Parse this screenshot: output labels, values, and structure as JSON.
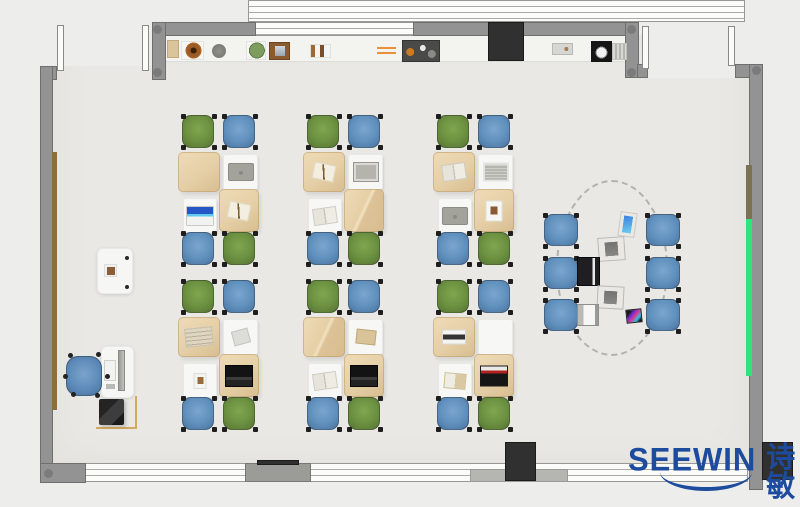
{
  "scene": {
    "kind": "floorplan-top-view-render",
    "room": "classroom / training room furniture layout render",
    "canvas": {
      "w": 800,
      "h": 507
    },
    "colors": {
      "outside": "#ededeb",
      "floor": "#e9e8e4",
      "wall": "#939393",
      "desk_tan": "#e5cfa6",
      "desk_white": "#f7f7f5",
      "chair_green": "#6b9040",
      "chair_blue": "#6090bd",
      "accent_strip_green": "#2ee57c",
      "logo_blue": "#1d4b9e"
    }
  },
  "logo": {
    "brand": "SEEWIN",
    "cjk": "诗敏"
  },
  "layout": {
    "statics": [
      {
        "cls": "floor",
        "name": "room-floor",
        "x": 53,
        "y": 35,
        "w": 696,
        "h": 428
      },
      {
        "cls": "outside",
        "name": "outside-area-top-left",
        "x": 0,
        "y": 0,
        "w": 152,
        "h": 66
      },
      {
        "cls": "outside",
        "name": "outside-area-top-right",
        "x": 648,
        "y": 0,
        "w": 101,
        "h": 78
      },
      {
        "cls": "counter",
        "name": "back-counter",
        "x": 166,
        "y": 35,
        "w": 461,
        "h": 27
      },
      {
        "cls": "window-h",
        "name": "window-band-top",
        "x": 248,
        "y": 0,
        "w": 497,
        "h": 22
      },
      {
        "cls": "window-h",
        "name": "window-band-top-inner",
        "x": 248,
        "y": 22,
        "w": 166,
        "h": 14
      },
      {
        "cls": "wall",
        "name": "wall-top-left-segment",
        "x": 152,
        "y": 22,
        "w": 104,
        "h": 14
      },
      {
        "cls": "wall",
        "name": "wall-top-right-segment",
        "x": 413,
        "y": 22,
        "w": 214,
        "h": 14
      },
      {
        "cls": "wall",
        "name": "door-post-left",
        "x": 152,
        "y": 22,
        "w": 14,
        "h": 58
      },
      {
        "cls": "wall",
        "name": "wall-corner-top-left",
        "x": 40,
        "y": 66,
        "w": 17,
        "h": 14
      },
      {
        "cls": "wall",
        "name": "wall-left",
        "x": 40,
        "y": 66,
        "w": 13,
        "h": 416
      },
      {
        "cls": "wall",
        "name": "door-post-right",
        "x": 625,
        "y": 22,
        "w": 14,
        "h": 56
      },
      {
        "cls": "wall",
        "name": "door-post-right-foot",
        "x": 637,
        "y": 64,
        "w": 11,
        "h": 14
      },
      {
        "cls": "wall",
        "name": "wall-corner-top-right",
        "x": 735,
        "y": 64,
        "w": 28,
        "h": 14
      },
      {
        "cls": "wall",
        "name": "wall-right",
        "x": 749,
        "y": 64,
        "w": 14,
        "h": 426
      },
      {
        "cls": "door",
        "name": "door-leaf",
        "x": 57,
        "y": 25,
        "w": 7,
        "h": 46
      },
      {
        "cls": "door",
        "name": "door-leaf",
        "x": 142,
        "y": 25,
        "w": 7,
        "h": 46
      },
      {
        "cls": "door",
        "name": "door-leaf",
        "x": 642,
        "y": 26,
        "w": 7,
        "h": 43
      },
      {
        "cls": "door",
        "name": "door-leaf",
        "x": 728,
        "y": 26,
        "w": 7,
        "h": 40
      },
      {
        "cls": "window-h",
        "name": "window-band-bottom",
        "x": 57,
        "y": 463,
        "w": 691,
        "h": 19
      },
      {
        "cls": "sill",
        "name": "window-sill-gray",
        "x": 470,
        "y": 469,
        "w": 98,
        "h": 13
      },
      {
        "cls": "wall",
        "name": "wall-corner-bottom-left",
        "x": 40,
        "y": 463,
        "w": 46,
        "h": 20
      },
      {
        "cls": "pillar-gray",
        "name": "pillar-bottom-gray",
        "x": 245,
        "y": 463,
        "w": 66,
        "h": 19
      },
      {
        "cls": "dark",
        "name": "lintel-dark",
        "x": 257,
        "y": 460,
        "w": 42,
        "h": 5
      },
      {
        "cls": "dark",
        "name": "pillar-dark-center",
        "x": 505,
        "y": 442,
        "w": 31,
        "h": 39
      },
      {
        "cls": "dark",
        "name": "pillar-dark-right",
        "x": 762,
        "y": 442,
        "w": 31,
        "h": 38
      },
      {
        "cls": "dark",
        "name": "cabinet-black",
        "x": 488,
        "y": 22,
        "w": 36,
        "h": 39
      },
      {
        "cls": "strip-brown",
        "name": "wall-rail-left",
        "x": 52,
        "y": 152,
        "w": 5,
        "h": 258
      },
      {
        "cls": "strip-olive",
        "name": "wall-rail-right-olive",
        "x": 746,
        "y": 165,
        "w": 6,
        "h": 54
      },
      {
        "cls": "strip-green",
        "name": "wall-strip-green",
        "x": 746,
        "y": 219,
        "w": 6,
        "h": 157
      },
      {
        "cls": "wall-dot",
        "name": "wall-joint-dot",
        "x": 153,
        "y": 25,
        "w": 9,
        "h": 9
      },
      {
        "cls": "wall-dot",
        "name": "wall-joint-dot",
        "x": 153,
        "y": 68,
        "w": 9,
        "h": 9
      },
      {
        "cls": "wall-dot",
        "name": "wall-joint-dot",
        "x": 627,
        "y": 25,
        "w": 9,
        "h": 9
      },
      {
        "cls": "wall-dot",
        "name": "wall-joint-dot",
        "x": 627,
        "y": 68,
        "w": 9,
        "h": 9
      },
      {
        "cls": "wall-dot",
        "name": "wall-joint-dot",
        "x": 752,
        "y": 66,
        "w": 9,
        "h": 9
      },
      {
        "cls": "wall-dot",
        "name": "wall-joint-dot",
        "x": 44,
        "y": 469,
        "w": 9,
        "h": 9
      },
      {
        "cls": "pod-ring",
        "name": "pod-dashed-outline",
        "x": 556,
        "y": 180,
        "w": 112,
        "h": 176
      }
    ],
    "counter_items": [
      {
        "cls": "ci-tanbox",
        "name": "shelf-item-box",
        "x": 167,
        "y": 40,
        "w": 12,
        "h": 18
      },
      {
        "cls": "ci-bowl",
        "name": "shelf-item-bowl",
        "x": 181,
        "y": 41,
        "w": 23,
        "h": 19
      },
      {
        "cls": "ci-graycircle",
        "name": "shelf-item-pot",
        "x": 212,
        "y": 44,
        "w": 14,
        "h": 14
      },
      {
        "cls": "ci-plant",
        "name": "shelf-item-plant",
        "x": 246,
        "y": 41,
        "w": 20,
        "h": 19
      },
      {
        "cls": "ci-frame",
        "name": "shelf-item-photo-frame",
        "x": 269,
        "y": 42,
        "w": 21,
        "h": 18
      },
      {
        "cls": "ci-books",
        "name": "shelf-item-books",
        "x": 310,
        "y": 44,
        "w": 21,
        "h": 14
      },
      {
        "cls": "ci-sticks",
        "name": "shelf-item-orange-sticks",
        "x": 377,
        "y": 47,
        "w": 19,
        "h": 7
      },
      {
        "cls": "ci-toolbox",
        "name": "shelf-item-toolbox",
        "x": 402,
        "y": 40,
        "w": 38,
        "h": 22
      },
      {
        "cls": "ci-graybox2",
        "name": "shelf-item-gray-box",
        "x": 552,
        "y": 43,
        "w": 21,
        "h": 12
      },
      {
        "cls": "ci-appliance",
        "name": "shelf-item-appliance",
        "x": 591,
        "y": 41,
        "w": 21,
        "h": 21
      },
      {
        "cls": "ci-stripes",
        "name": "shelf-item-striped-box",
        "x": 612,
        "y": 43,
        "w": 15,
        "h": 17
      }
    ],
    "teacher": [
      {
        "cls": "tdesk",
        "name": "side-table",
        "x": 97,
        "y": 248,
        "w": 36,
        "h": 46
      },
      {
        "cls": "titem-brown",
        "name": "side-table-item",
        "x": 104,
        "y": 264,
        "w": 13,
        "h": 13
      },
      {
        "cls": "tdot",
        "name": "table-dot",
        "x": 125,
        "y": 256,
        "w": 4,
        "h": 4
      },
      {
        "cls": "tdot",
        "name": "table-dot",
        "x": 125,
        "y": 285,
        "w": 4,
        "h": 4
      },
      {
        "cls": "tdesk",
        "name": "teacher-desk",
        "x": 101,
        "y": 346,
        "w": 33,
        "h": 52
      },
      {
        "cls": "tmonitor",
        "name": "teacher-monitor",
        "x": 118,
        "y": 350,
        "w": 7,
        "h": 41
      },
      {
        "cls": "tkeyboard",
        "name": "teacher-keyboard",
        "x": 104,
        "y": 360,
        "w": 12,
        "h": 21
      },
      {
        "cls": "tgray",
        "name": "teacher-desk-item",
        "x": 106,
        "y": 384,
        "w": 9,
        "h": 5
      },
      {
        "cls": "tchair",
        "name": "teacher-chair",
        "x": 66,
        "y": 356,
        "w": 36,
        "h": 40
      },
      {
        "cls": "tdeskL",
        "name": "printer-stand",
        "x": 96,
        "y": 396,
        "w": 41,
        "h": 33
      },
      {
        "cls": "tprinter",
        "name": "printer",
        "x": 99,
        "y": 399,
        "w": 25,
        "h": 26
      }
    ]
  },
  "clusters": {
    "desk_offsets": [
      {
        "dx": 0,
        "dy": 0,
        "w": 42,
        "h": 40,
        "kind": "tan"
      },
      {
        "dx": 45,
        "dy": 2,
        "w": 35,
        "h": 36,
        "kind": "white"
      },
      {
        "dx": 5,
        "dy": 46,
        "w": 34,
        "h": 35,
        "kind": "white"
      },
      {
        "dx": 41,
        "dy": 37,
        "w": 40,
        "h": 43,
        "kind": "tan"
      }
    ],
    "chair_offsets": [
      {
        "dx": 4,
        "dy": -37
      },
      {
        "dx": 45,
        "dy": -37
      },
      {
        "dx": 4,
        "dy": 80
      },
      {
        "dx": 45,
        "dy": 80
      }
    ],
    "chair_colors": [
      "green",
      "blue",
      "blue",
      "green"
    ],
    "chair_size": {
      "w": 32,
      "h": 33
    },
    "units": [
      {
        "x": 178,
        "y": 152,
        "items": [
          "none",
          "laptop-gray",
          "laptop-blue",
          "paper-pen"
        ]
      },
      {
        "x": 303,
        "y": 152,
        "items": [
          "paper-pen",
          "tablet-gray",
          "book-open",
          "fold"
        ]
      },
      {
        "x": 433,
        "y": 152,
        "items": [
          "book-open",
          "notebook-stripe",
          "laptop-gray",
          "paper-photo"
        ]
      },
      {
        "x": 178,
        "y": 317,
        "items": [
          "magazine",
          "paper-folded",
          "photo-card",
          "laptop-dark"
        ]
      },
      {
        "x": 303,
        "y": 317,
        "items": [
          "fold",
          "notebook-tan",
          "book-open",
          "laptop-dark"
        ]
      },
      {
        "x": 433,
        "y": 317,
        "items": [
          "keyboard-white",
          "none",
          "book-tan",
          "laptop-red"
        ]
      }
    ]
  },
  "pod": {
    "chair_size": {
      "w": 34,
      "h": 32
    },
    "chairs": [
      {
        "x": 544,
        "y": 214
      },
      {
        "x": 544,
        "y": 257
      },
      {
        "x": 544,
        "y": 299
      },
      {
        "x": 646,
        "y": 214
      },
      {
        "x": 646,
        "y": 257
      },
      {
        "x": 646,
        "y": 299
      }
    ],
    "devices": [
      {
        "cls": "dev-tablet-blue",
        "name": "pod-tablet",
        "x": 619,
        "y": 212,
        "w": 17,
        "h": 25,
        "rot": 8
      },
      {
        "cls": "dev-graybox",
        "name": "pod-device",
        "x": 598,
        "y": 237,
        "w": 27,
        "h": 24,
        "rot": -4
      },
      {
        "cls": "dev-laptop-dark",
        "name": "pod-laptop",
        "x": 577,
        "y": 257,
        "w": 23,
        "h": 29,
        "rot": 0
      },
      {
        "cls": "dev-graybox",
        "name": "pod-device",
        "x": 597,
        "y": 286,
        "w": 27,
        "h": 23,
        "rot": 3
      },
      {
        "cls": "dev-laptop-white",
        "name": "pod-laptop",
        "x": 577,
        "y": 304,
        "w": 22,
        "h": 22,
        "rot": 0
      },
      {
        "cls": "dev-phone",
        "name": "pod-phone",
        "x": 626,
        "y": 309,
        "w": 16,
        "h": 14,
        "rot": -6
      }
    ]
  }
}
